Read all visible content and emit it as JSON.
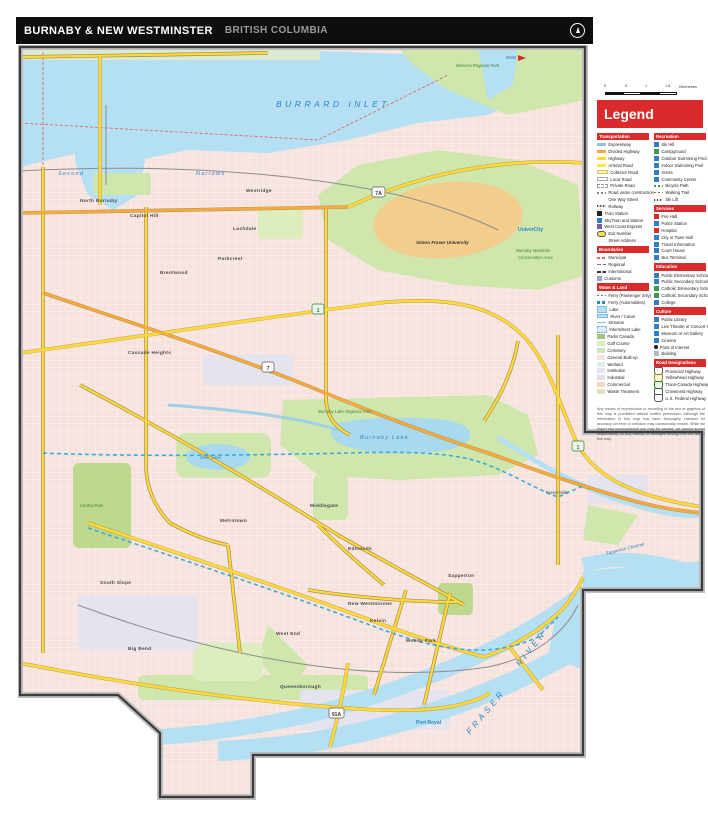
{
  "title": {
    "main": "BURNABY & NEW WESTMINSTER",
    "region": "BRITISH COLUMBIA"
  },
  "scale_bar": {
    "ticks": [
      "0",
      ".5",
      "1",
      "1.5"
    ],
    "unit": "Kilometres"
  },
  "legend": {
    "title": "Legend",
    "left": [
      {
        "h": "Transportation",
        "items": [
          "Expressway",
          "Divided Highway",
          "Highway",
          "Arterial Road",
          "Collector Road",
          "Local Road",
          "Private Road",
          "Road under construction",
          "One Way Street",
          "Railway",
          "Train Station",
          "SkyTrain and Station",
          "West Coast Express",
          "Exit Number",
          "Street Address"
        ]
      },
      {
        "h": "Boundaries",
        "items": [
          "Municipal",
          "Regional",
          "International",
          "Customs"
        ]
      },
      {
        "h": "Water & Land",
        "items": [
          "Ferry (Passenger only)",
          "Ferry (Automobiles)",
          "Lake",
          "River / Canal",
          "Streams",
          "Intermittent Lake",
          "Parks Canada",
          "Golf Course",
          "Cemetery",
          "General Built-up",
          "Wetland",
          "Institution",
          "Industrial",
          "Commercial",
          "Waste Treatment"
        ]
      }
    ],
    "right": [
      {
        "h": "Recreation",
        "items": [
          "Ski Hill",
          "Campground",
          "Outdoor Swimming Pool",
          "Indoor Swimming Pool",
          "Arena",
          "Community Centre",
          "Bicycle Path",
          "Walking Trail",
          "Ski Lift"
        ]
      },
      {
        "h": "Services",
        "items": [
          "Fire Hall",
          "Police Station",
          "Hospital",
          "City or Town Hall",
          "Travel Information",
          "Court House",
          "Bus Terminal"
        ]
      },
      {
        "h": "Education",
        "items": [
          "Public Elementary School",
          "Public Secondary School",
          "Catholic Elementary School",
          "Catholic Secondary School",
          "College"
        ]
      },
      {
        "h": "Culture",
        "items": [
          "Public Library",
          "Live Theatre or Concert Hall",
          "Museum or Art Gallery",
          "Cinema",
          "Point of Interest",
          "Building"
        ]
      },
      {
        "h": "Road Designations",
        "items": [
          "Provincial Highway",
          "Yellowhead Highway",
          "Trans-Canada Highway",
          "Crowsnest Highway",
          "U.S. Federal Highway"
        ]
      }
    ]
  },
  "disclaimer": "Any means of reproduction or recording of the text or graphics of this map is prohibited without written permission. Although the information in this map has been thoroughly checked for accuracy, an error or omission may occasionally remain. While we regret any inconvenience you may be caused, we cannot accept responsibility for any mishap or damages arising from the use of this map.",
  "map": {
    "labels": [
      {
        "text": "BURRARD INLET"
      },
      {
        "text": "Second"
      },
      {
        "text": "Narrows"
      },
      {
        "text": "Belcarra Regional Park"
      },
      {
        "text": "Simon Fraser University"
      },
      {
        "text": "UniverCity"
      },
      {
        "text": "Burnaby Mountain"
      },
      {
        "text": "Conservation Area"
      },
      {
        "text": "Burnaby Lake"
      },
      {
        "text": "Deer Lake"
      },
      {
        "text": "FRASER"
      },
      {
        "text": "RIVER"
      },
      {
        "text": "Sapperton Channel"
      },
      {
        "text": "Fraser Mills"
      },
      {
        "text": "North Burnaby"
      },
      {
        "text": "Capitol Hill"
      },
      {
        "text": "Westridge"
      },
      {
        "text": "Lochdale"
      },
      {
        "text": "Parkcrest"
      },
      {
        "text": "Brentwood"
      },
      {
        "text": "Cascade Heights"
      },
      {
        "text": "Metrotown"
      },
      {
        "text": "South Slope"
      },
      {
        "text": "Big Bend"
      },
      {
        "text": "Edmonds"
      },
      {
        "text": "Middlegate"
      },
      {
        "text": "West End"
      },
      {
        "text": "Kelvin"
      },
      {
        "text": "Moody Park"
      },
      {
        "text": "Queensborough"
      },
      {
        "text": "Sapperton"
      },
      {
        "text": "Port Royal"
      },
      {
        "text": "Burnaby Lake Regional Park"
      },
      {
        "text": "Central Park"
      },
      {
        "text": "New Westminster"
      }
    ],
    "shields": [
      {
        "text": "1"
      },
      {
        "text": "1"
      },
      {
        "text": "7"
      },
      {
        "text": "7A"
      },
      {
        "text": "91A"
      }
    ]
  },
  "colors": {
    "accent_red": "#d92b2b",
    "title_bar": "#0e0e0e",
    "water": "#b5dff2",
    "water_text": "#2f86c4",
    "park": "#cfe6ac",
    "urban": "#f7e3de",
    "campus": "#f2cd8c",
    "road_yellow": "#ffd83c",
    "road_orange": "#f5a93f",
    "skytrain_blue": "#3fa9dc",
    "boundary_red": "#e06666"
  }
}
